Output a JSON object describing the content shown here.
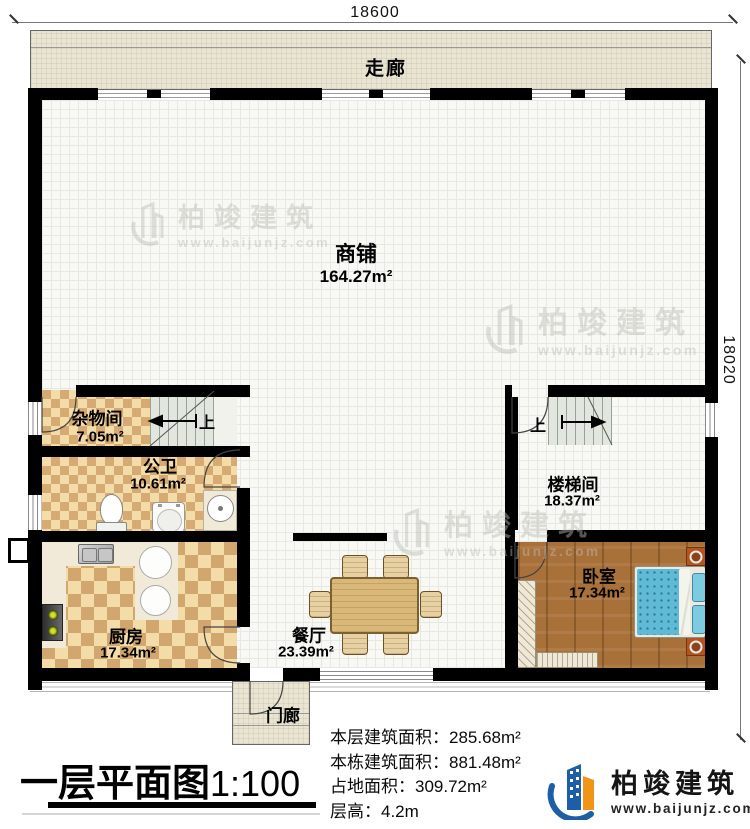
{
  "dimensions": {
    "top": "18600",
    "right": "18020"
  },
  "rooms": {
    "corridor": {
      "name": "走廊"
    },
    "shop": {
      "name": "商铺",
      "area": "164.27m²"
    },
    "storage": {
      "name": "杂物间",
      "area": "7.05m²"
    },
    "bathroom": {
      "name": "公卫",
      "area": "10.61m²"
    },
    "kitchen": {
      "name": "厨房",
      "area": "17.34m²"
    },
    "dining": {
      "name": "餐厅",
      "area": "23.39m²"
    },
    "stairwell": {
      "name": "楼梯间",
      "area": "18.37m²"
    },
    "bedroom": {
      "name": "卧室",
      "area": "17.34m²"
    },
    "porch": {
      "name": "门廊"
    }
  },
  "stairs": {
    "up_left": "上",
    "up_right": "上"
  },
  "title": {
    "main": "一层平面图",
    "scale": "1:100"
  },
  "info": {
    "lines": [
      "本层建筑面积：285.68m²",
      "本栋建筑面积：881.48m²",
      "占地面积：309.72m²",
      "层高：4.2m"
    ]
  },
  "brand": {
    "name": "柏竣建筑",
    "url": "www.baijunjz.com"
  },
  "watermark": {
    "name": "柏竣建筑",
    "url": "www.baijunjz.com"
  },
  "colors": {
    "wall": "#000000",
    "corridor": "#e9e5d0",
    "checker_light": "#f3dca7",
    "checker_dark": "#d2a76f",
    "wood": "#a9713a",
    "bed": "#5fbad6",
    "brand_blue": "#1c5fa8",
    "brand_orange": "#f19517"
  }
}
